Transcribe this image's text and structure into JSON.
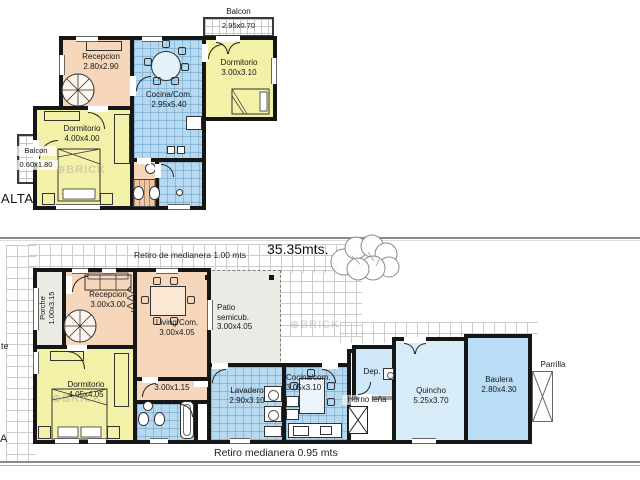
{
  "upper": {
    "plan_label": "ALTA",
    "balcon_top": {
      "name": "Balcon",
      "dim": "2.95x0.70"
    },
    "balcon_left": {
      "name": "Balcon",
      "dim": "0.60x1.80"
    },
    "recepcion": {
      "name": "Recepcion",
      "dim": "2.80x2.90"
    },
    "cocina": {
      "name": "Cocina/Com.",
      "dim": "2.95x5.40"
    },
    "dormitorio_right": {
      "name": "Dormitorio",
      "dim": "3.00x3.10"
    },
    "dormitorio_left": {
      "name": "Dormitorio",
      "dim": "4.00x4.00"
    }
  },
  "ground": {
    "plan_label": "A",
    "street_label": "te",
    "retiro_top": "Retiro de medianera 1.00 mts",
    "length_label": "35.35mts.",
    "retiro_bottom": "Retiro medianera  0.95 mts",
    "porche": {
      "name": "Porche",
      "dim": "1.00x3.15"
    },
    "recepcion": {
      "name": "Recepcion",
      "dim": "3.00x3.00"
    },
    "living": {
      "name": "Living/Com.",
      "dim": "3.00x4.05"
    },
    "patio": {
      "line1": "Patio",
      "line2": "semicub.",
      "dim": "3.00x4.05"
    },
    "dormitorio": {
      "name": "Dormitorio",
      "dim": "4.05x4.05"
    },
    "hall": {
      "dim": "3.00x1.15"
    },
    "lavadero": {
      "name": "Lavadero",
      "dim": "2.90x3.10"
    },
    "cocina": {
      "name": "Cocina/com.",
      "dim": "3.05x3.10"
    },
    "dep": {
      "name": "Dep."
    },
    "horno": {
      "name": "Horno leña"
    },
    "quincho": {
      "name": "Quincho",
      "dim": "5.25x3.70"
    },
    "baulera": {
      "name": "Baulera",
      "dim": "2.80x4.30"
    },
    "parrilla": {
      "name": "Parrilla"
    }
  },
  "watermark": "⊕BRICK",
  "colors": {
    "wall": "#161616",
    "salmon": "#f7d7bb",
    "yellow": "#f3f0a8",
    "blue_tile": "#b7d9f0",
    "blue_light": "#d9edf9",
    "blue_medium": "#b9ddf5",
    "gray_room": "#eceae4",
    "patio_grid_line": "#cccccc"
  }
}
